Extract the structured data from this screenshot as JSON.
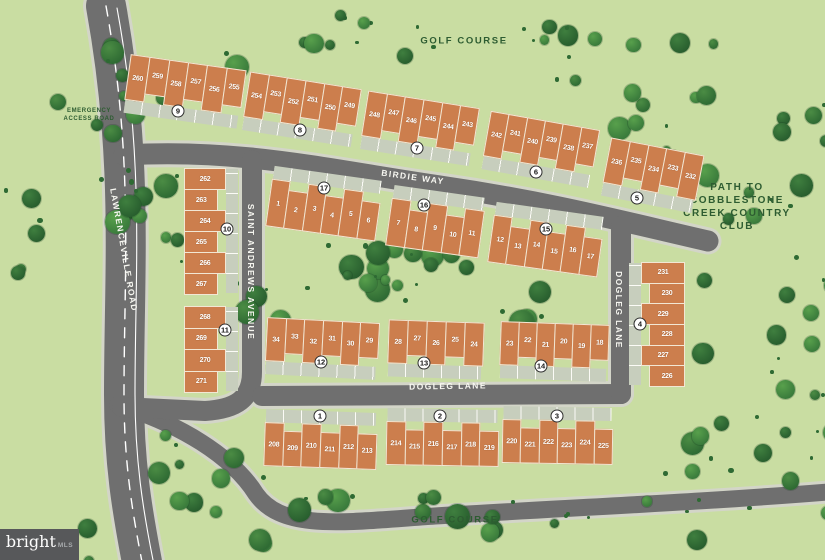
{
  "area_labels": {
    "golf_course_top": "GOLF COURSE",
    "golf_course_bottom": "GOLF COURSE",
    "path_to_club": "PATH TO COBBLESTONE CREEK COUNTRY CLUB",
    "emergency_line1": "EMERGENCY",
    "emergency_line2": "ACCESS ROAD"
  },
  "streets": {
    "birdie_way": "BIRDIE WAY",
    "saint_andrews": "SAINT ANDREWS AVENUE",
    "dogleg_horizontal": "DOGLEG LANE",
    "dogleg_vertical": "DOGLEG LANE",
    "lawrenceville": "LAWRENCEVILLE ROAD"
  },
  "colors": {
    "background": "#c9dda2",
    "road": "#6f6f6f",
    "road_edge": "#d3d5c8",
    "building": "#cc7e4d",
    "tree_dark": "#2e6a33",
    "label_green": "#2d5c31"
  },
  "watermark": {
    "brand": "bright",
    "suffix": "MLS"
  },
  "buildings": [
    {
      "lots": [
        "260",
        "259",
        "258",
        "257",
        "256",
        "255"
      ],
      "badge": "9",
      "x": 127,
      "y": 62,
      "w": 116,
      "h": 46,
      "rot": 8,
      "dir": "h",
      "drive": "bottom",
      "badge_x": 178,
      "badge_y": 111
    },
    {
      "lots": [
        "254",
        "253",
        "252",
        "251",
        "250",
        "249"
      ],
      "badge": "8",
      "x": 246,
      "y": 80,
      "w": 112,
      "h": 46,
      "rot": 9,
      "dir": "h",
      "drive": "bottom",
      "badge_x": 300,
      "badge_y": 130
    },
    {
      "lots": [
        "248",
        "247",
        "246",
        "245",
        "244",
        "243"
      ],
      "badge": "7",
      "x": 364,
      "y": 99,
      "w": 112,
      "h": 46,
      "rot": 9,
      "dir": "h",
      "drive": "bottom",
      "badge_x": 417,
      "badge_y": 148
    },
    {
      "lots": [
        "242",
        "241",
        "240",
        "239",
        "238",
        "237"
      ],
      "badge": "6",
      "x": 486,
      "y": 120,
      "w": 110,
      "h": 46,
      "rot": 10,
      "dir": "h",
      "drive": "bottom",
      "badge_x": 536,
      "badge_y": 172
    },
    {
      "lots": [
        "236",
        "235",
        "234",
        "233",
        "232"
      ],
      "badge": "5",
      "x": 606,
      "y": 146,
      "w": 94,
      "h": 46,
      "rot": 11,
      "dir": "h",
      "drive": "bottom",
      "badge_x": 637,
      "badge_y": 198
    },
    {
      "lots": [
        "1",
        "2",
        "3",
        "4",
        "5",
        "6"
      ],
      "badge": "17",
      "x": 268,
      "y": 186,
      "w": 110,
      "h": 48,
      "rot": 8,
      "dir": "h",
      "drive": "top",
      "badge_x": 324,
      "badge_y": 188
    },
    {
      "lots": [
        "7",
        "8",
        "9",
        "10",
        "11"
      ],
      "badge": "16",
      "x": 388,
      "y": 204,
      "w": 93,
      "h": 48,
      "rot": 8,
      "dir": "h",
      "drive": "top",
      "badge_x": 424,
      "badge_y": 205
    },
    {
      "lots": [
        "12",
        "13",
        "14",
        "15",
        "16",
        "17"
      ],
      "badge": "15",
      "x": 490,
      "y": 222,
      "w": 110,
      "h": 48,
      "rot": 8,
      "dir": "h",
      "drive": "top",
      "badge_x": 546,
      "badge_y": 229
    },
    {
      "lots": [
        "34",
        "33",
        "32",
        "31",
        "30",
        "29"
      ],
      "badge": "12",
      "x": 266,
      "y": 320,
      "w": 112,
      "h": 44,
      "rot": 3,
      "dir": "h",
      "drive": "bottom",
      "badge_x": 321,
      "badge_y": 362
    },
    {
      "lots": [
        "28",
        "27",
        "26",
        "25",
        "24"
      ],
      "badge": "13",
      "x": 388,
      "y": 321,
      "w": 95,
      "h": 44,
      "rot": 2,
      "dir": "h",
      "drive": "bottom",
      "badge_x": 424,
      "badge_y": 363
    },
    {
      "lots": [
        "23",
        "22",
        "21",
        "20",
        "19",
        "18"
      ],
      "badge": "14",
      "x": 500,
      "y": 323,
      "w": 108,
      "h": 44,
      "rot": 2,
      "dir": "h",
      "drive": "bottom",
      "badge_x": 541,
      "badge_y": 366
    },
    {
      "lots": [
        "208",
        "209",
        "210",
        "211",
        "212",
        "213"
      ],
      "badge": "1",
      "x": 264,
      "y": 424,
      "w": 112,
      "h": 44,
      "rot": 2,
      "dir": "h",
      "drive": "top",
      "badge_x": 320,
      "badge_y": 416
    },
    {
      "lots": [
        "214",
        "215",
        "216",
        "217",
        "218",
        "219"
      ],
      "badge": "2",
      "x": 386,
      "y": 422,
      "w": 112,
      "h": 44,
      "rot": 1,
      "dir": "h",
      "drive": "top",
      "badge_x": 440,
      "badge_y": 416
    },
    {
      "lots": [
        "220",
        "221",
        "222",
        "223",
        "224",
        "225"
      ],
      "badge": "3",
      "x": 502,
      "y": 420,
      "w": 110,
      "h": 44,
      "rot": 1,
      "dir": "h",
      "drive": "top",
      "badge_x": 557,
      "badge_y": 416
    },
    {
      "lots": [
        "262",
        "263",
        "264",
        "265",
        "266",
        "267"
      ],
      "badge": "10",
      "x": 184,
      "y": 168,
      "w": 42,
      "h": 126,
      "rot": 0,
      "dir": "v",
      "drive": "right",
      "badge_x": 227,
      "badge_y": 229
    },
    {
      "lots": [
        "268",
        "269",
        "270",
        "271"
      ],
      "badge": "11",
      "x": 184,
      "y": 306,
      "w": 42,
      "h": 86,
      "rot": 0,
      "dir": "v",
      "drive": "right",
      "badge_x": 225,
      "badge_y": 330
    },
    {
      "lots": [
        "231",
        "230",
        "229",
        "228",
        "227",
        "226"
      ],
      "badge": "4",
      "x": 641,
      "y": 262,
      "w": 44,
      "h": 124,
      "rot": 0,
      "dir": "v",
      "drive": "left",
      "badge_x": 640,
      "badge_y": 324
    }
  ]
}
